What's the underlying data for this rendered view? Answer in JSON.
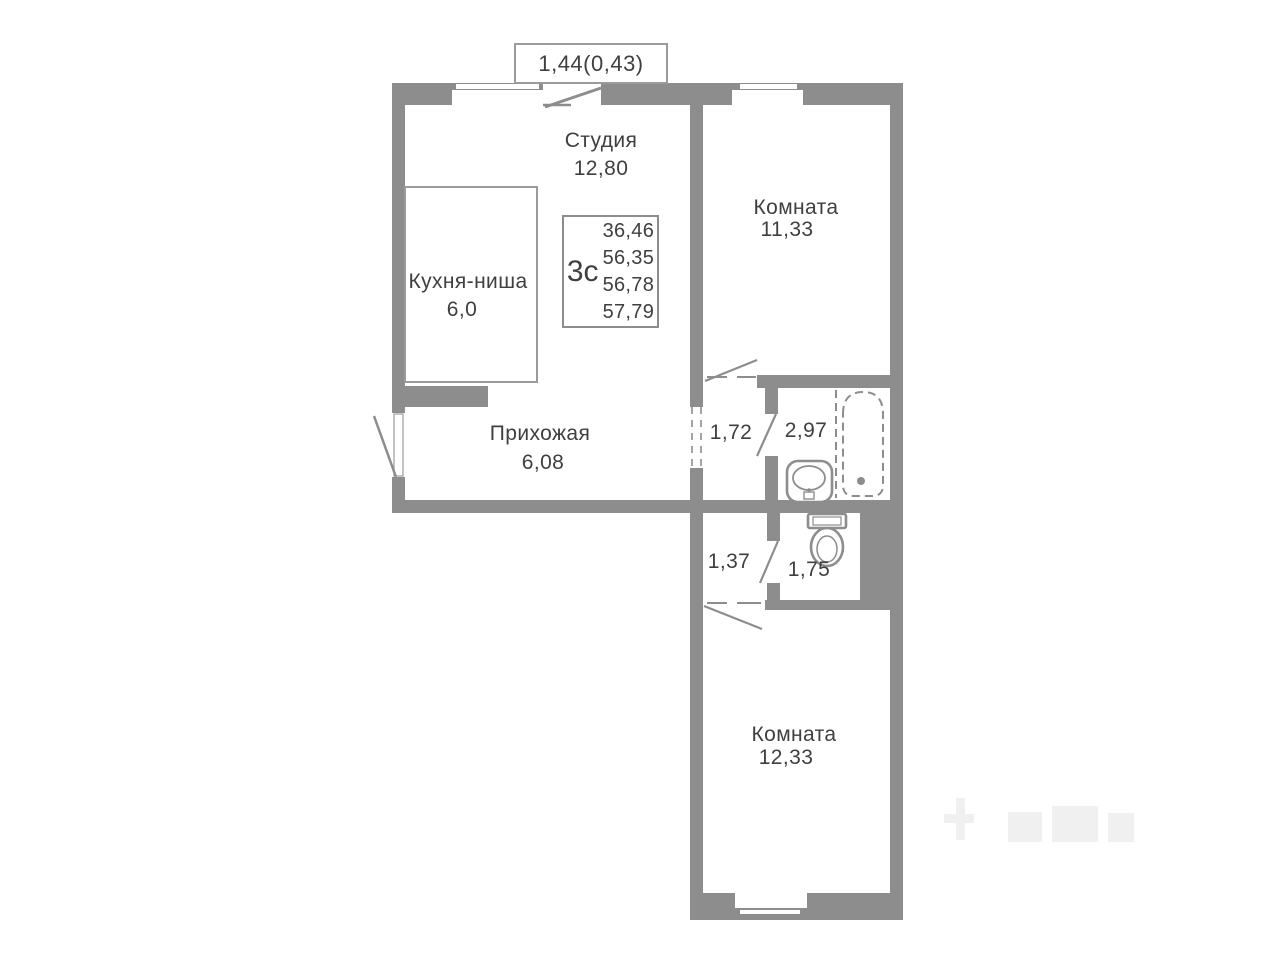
{
  "plan": {
    "title": "apartment-floor-plan",
    "balcony_label": "1,44(0,43)",
    "info_box": {
      "type_label": "3с",
      "areas": [
        "36,46",
        "56,35",
        "56,78",
        "57,79"
      ]
    },
    "rooms": {
      "studio": {
        "name": "Студия",
        "area": "12,80"
      },
      "room_top": {
        "name": "Комната",
        "area": "11,33"
      },
      "kitchen": {
        "name": "Кухня-ниша",
        "area": "6,0"
      },
      "hallway": {
        "name": "Прихожая",
        "area": "6,08"
      },
      "corridor1": {
        "area": "1,72"
      },
      "bathroom": {
        "area": "2,97"
      },
      "corridor2": {
        "area": "1,37"
      },
      "wc": {
        "area": "1,75"
      },
      "room_bottom": {
        "name": "Комната",
        "area": "12,33"
      }
    },
    "icons": [
      "stove-icon",
      "kitchen-sink-icon",
      "washbasin-icon",
      "bathtub-icon",
      "toilet-icon",
      "window",
      "door-swing-line",
      "dashed-opening"
    ],
    "colors": {
      "wall": "#8d8d8d",
      "thin_line": "#9b9b9b",
      "text": "#3f3f3f",
      "background": "#ffffff",
      "watermark": "#f0f0f0"
    }
  }
}
